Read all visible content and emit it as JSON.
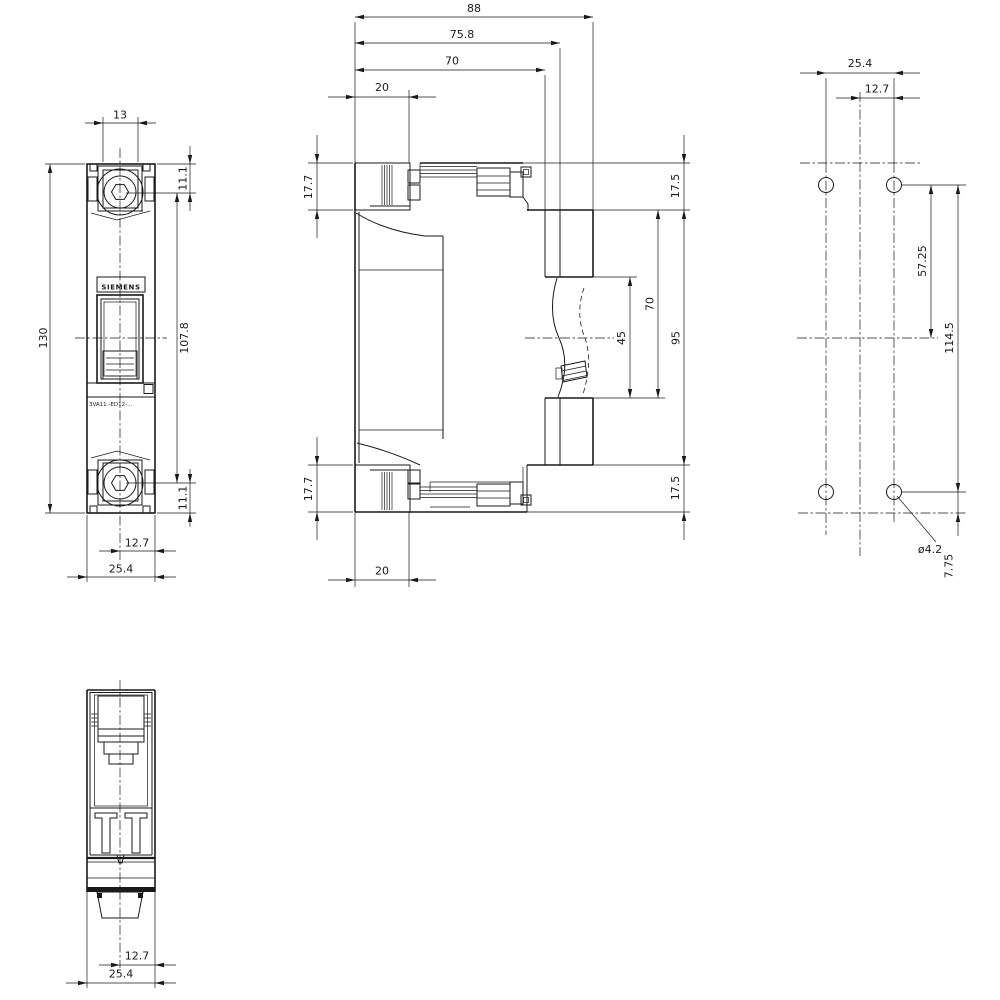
{
  "front_view": {
    "brand_label": "SIEMENS",
    "product_label": "3VA11.-ED12-...",
    "dimensions": {
      "terminal_opening_width": "13",
      "screw_offset_top": "11.1",
      "overall_height": "130",
      "screw_spacing": "107.8",
      "screw_offset_bottom": "11.1",
      "center_to_edge": "12.7",
      "overall_width": "25.4"
    }
  },
  "side_view": {
    "dimensions": {
      "overall_depth": "88",
      "depth_to_mounting_foot": "75.8",
      "body_depth": "70",
      "terminal_depth_top": "20",
      "terminal_height_top": "17.7",
      "top_step_height": "17.5",
      "rear_face_height": "95",
      "rear_opening_span": "70",
      "din_rail_recess": "45",
      "terminal_height_bottom": "17.7",
      "bottom_step_height": "17.5",
      "terminal_depth_bottom": "20"
    }
  },
  "drill_plan_view": {
    "dimensions": {
      "hole_pitch_horizontal": "25.4",
      "center_to_hole_column": "12.7",
      "hole_row_to_center": "57.25",
      "hole_pitch_vertical": "114.5",
      "hole_diameter": "ø4.2",
      "hole_to_bottom_edge": "7.75"
    }
  },
  "bottom_view": {
    "dimensions": {
      "center_to_edge": "12.7",
      "overall_width": "25.4"
    }
  }
}
